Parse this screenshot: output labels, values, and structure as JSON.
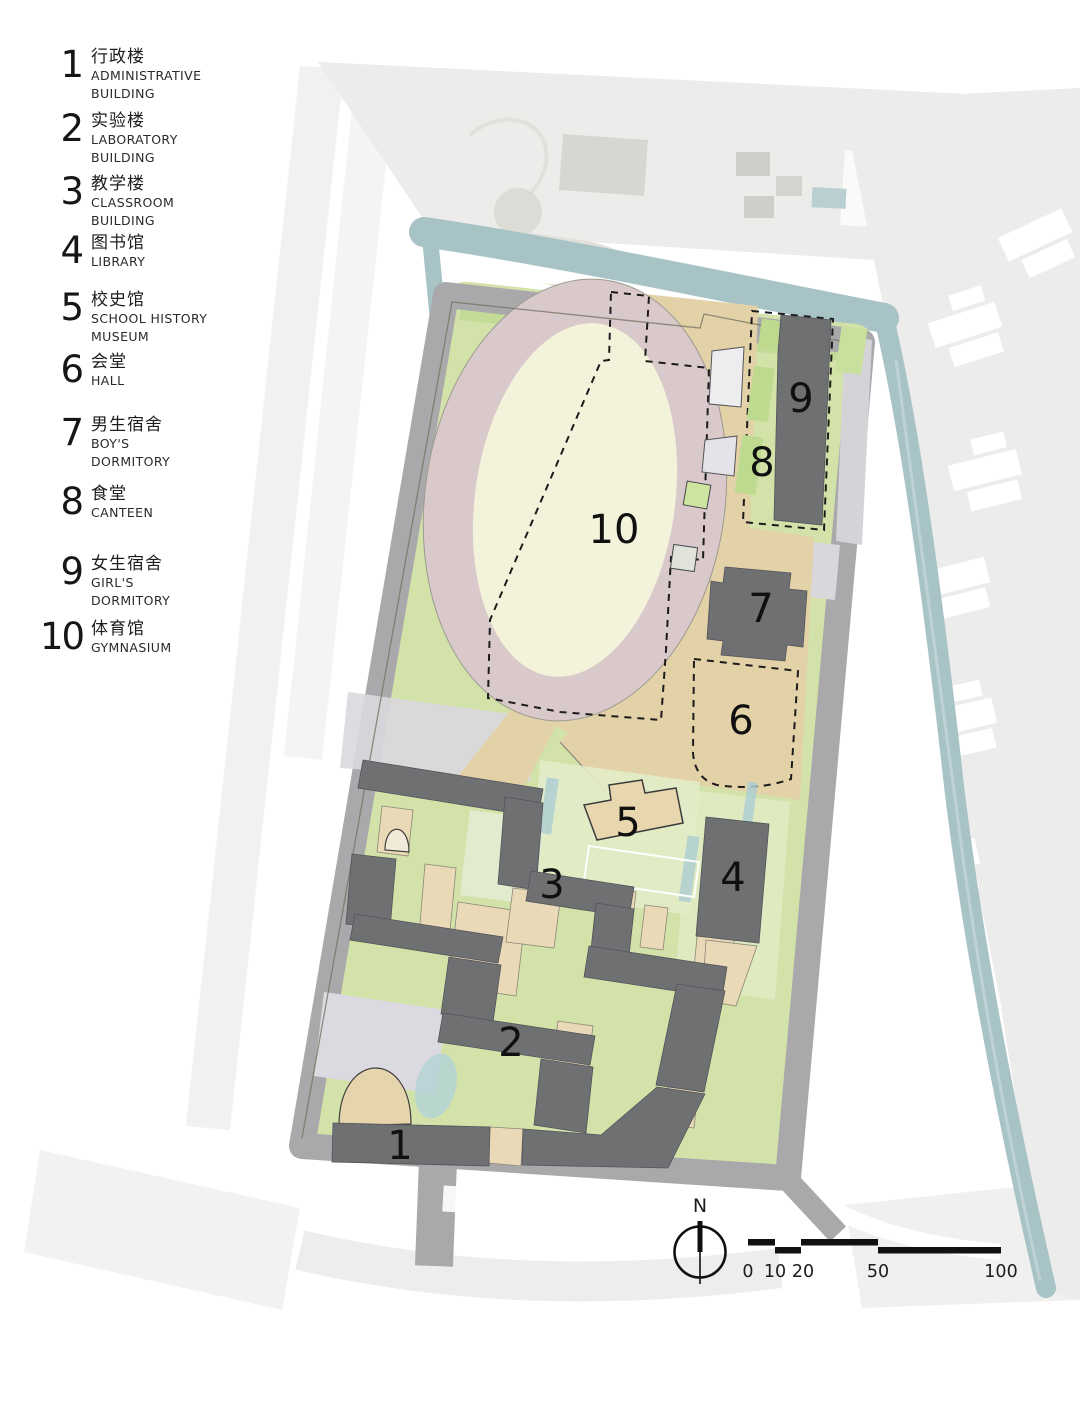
{
  "legend": {
    "items": [
      {
        "num": "1",
        "zh": "行政楼",
        "en1": "ADMINISTRATIVE",
        "en2": "BUILDING"
      },
      {
        "num": "2",
        "zh": "实验楼",
        "en1": "LABORATORY",
        "en2": "BUILDING"
      },
      {
        "num": "3",
        "zh": "教学楼",
        "en1": "CLASSROOM",
        "en2": "BUILDING"
      },
      {
        "num": "4",
        "zh": "图书馆",
        "en1": "LIBRARY",
        "en2": ""
      },
      {
        "num": "5",
        "zh": "校史馆",
        "en1": "SCHOOL HISTORY",
        "en2": "MUSEUM"
      },
      {
        "num": "6",
        "zh": "会堂",
        "en1": "HALL",
        "en2": ""
      },
      {
        "num": "7",
        "zh": "男生宿舍",
        "en1": "BOY'S",
        "en2": "DORMITORY"
      },
      {
        "num": "8",
        "zh": "食堂",
        "en1": "CANTEEN",
        "en2": ""
      },
      {
        "num": "9",
        "zh": "女生宿舍",
        "en1": "GIRL'S",
        "en2": "DORMITORY"
      },
      {
        "num": "10",
        "zh": "体育馆",
        "en1": "GYMNASIUM",
        "en2": ""
      }
    ]
  },
  "plan": {
    "labels": {
      "b1": "1",
      "b2": "2",
      "b3": "3",
      "b4": "4",
      "b5": "5",
      "b6": "6",
      "b7": "7",
      "b8": "8",
      "b9": "9",
      "b10": "10"
    }
  },
  "north": {
    "label": "N"
  },
  "scalebar": {
    "ticks": [
      "0",
      "10",
      "20",
      "50",
      "100"
    ]
  },
  "colors": {
    "water": "#a8c3c5",
    "road": "#a9a9ab",
    "green": "#d3e2a9",
    "green_dark": "#c3db97",
    "plaza_tan": "#e3d1a8",
    "track": "#dac9ca",
    "infield": "#f2f3da",
    "building_dark": "#6f7072",
    "context": "#ececeb",
    "ink": "#161616"
  }
}
